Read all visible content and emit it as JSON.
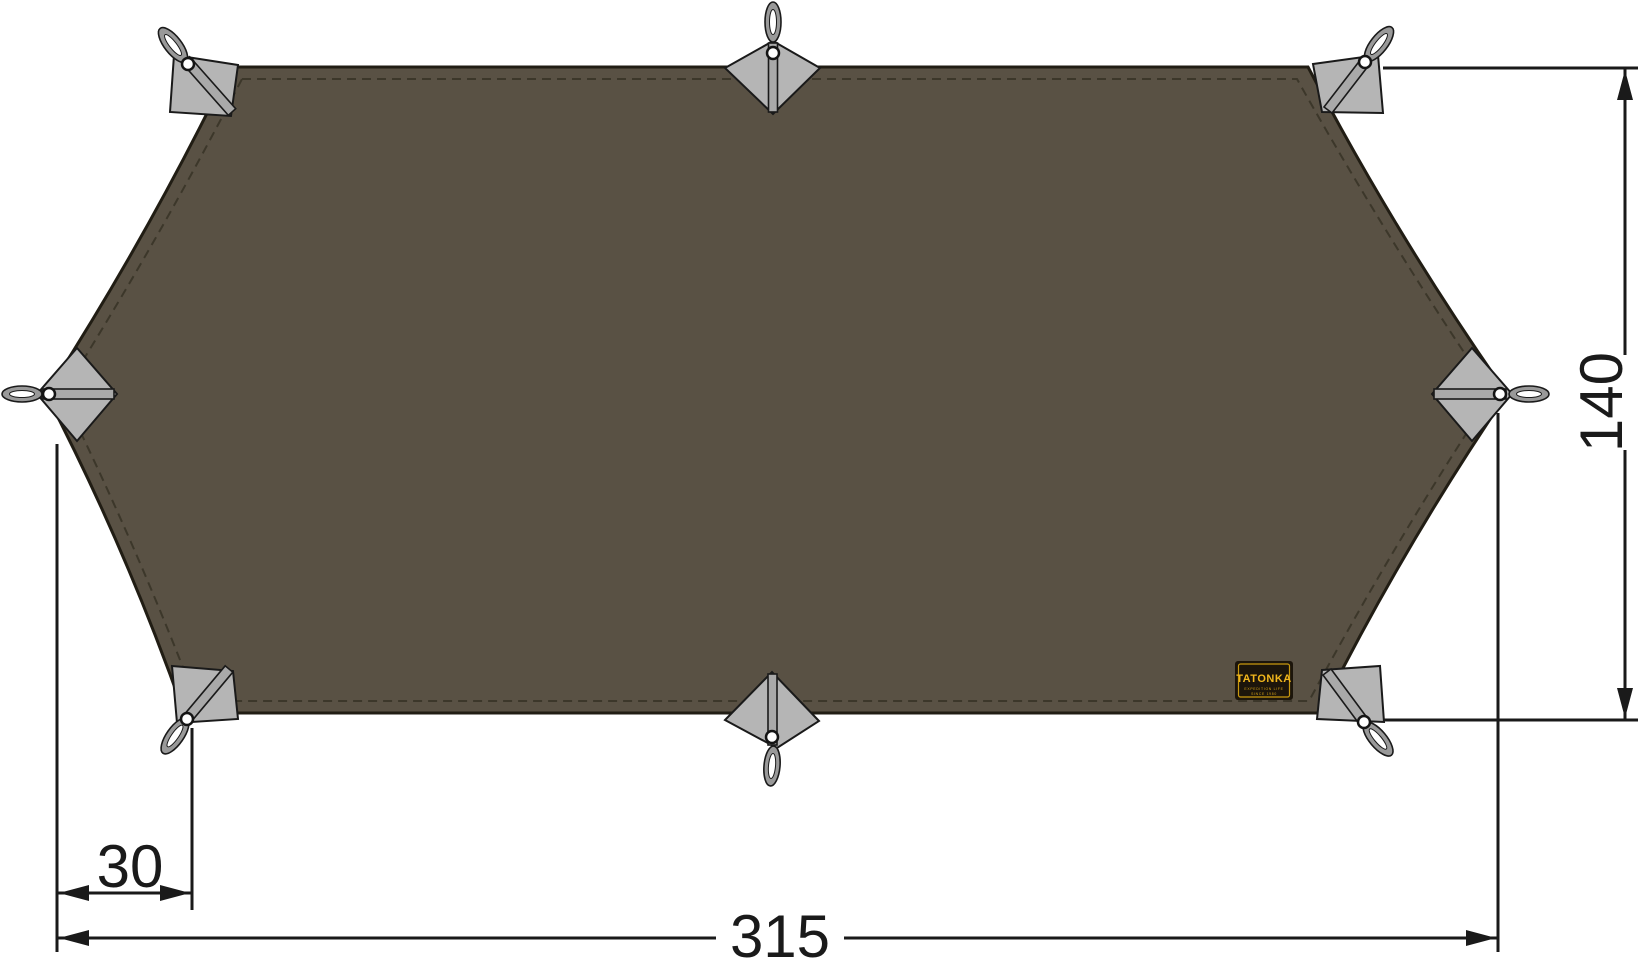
{
  "title": "Tarp technical drawing, top view",
  "dimensions": {
    "width_label": "315",
    "height_label": "140",
    "corner_offset_label": "30"
  },
  "brand_patch": {
    "brand": "TATONKA",
    "tagline": "EXPEDITION LIFE",
    "since": "SINCE 1980"
  },
  "attachment_points": {
    "count": 8,
    "description": "gray reinforcement patches with webbing loops and grommets"
  },
  "colors": {
    "background": "#ffffff",
    "fabric": "#595144",
    "fabric_outline": "#211d14",
    "stitching": "#3c372a",
    "reinforcement_patch": "#b5b5b5",
    "strap": "#a9a9a9",
    "webbing_loop": "#999999",
    "dimension_lines": "#1a1a1a",
    "brand_patch_background": "#1c150b",
    "brand_patch_accent": "#f2b71c"
  }
}
